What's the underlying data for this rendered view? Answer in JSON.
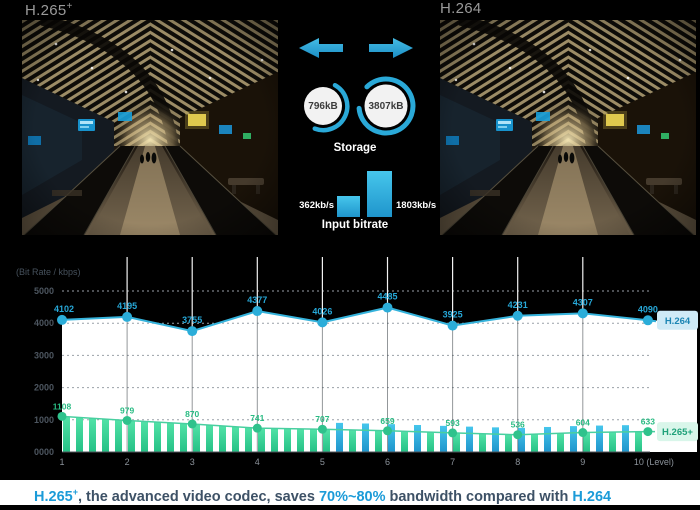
{
  "header": {
    "left_label_base": "H.265",
    "left_label_sup": "+",
    "right_label": "H.264"
  },
  "comparison": {
    "accent_color": "#29a9d9",
    "storage": {
      "title": "Storage",
      "left_value": "796kB",
      "right_value": "3807kB"
    },
    "bitrate": {
      "title": "Input bitrate",
      "left_value": "362kb/s",
      "right_value": "1803kb/s"
    }
  },
  "chart_data": {
    "type": "line",
    "title": "",
    "ylabel": "(Bit Rate / kbps)",
    "xlabel": "Level",
    "x": [
      1,
      2,
      3,
      4,
      5,
      6,
      7,
      8,
      9,
      10
    ],
    "x_tick_labels": [
      "1",
      "2",
      "3",
      "4",
      "5",
      "6",
      "7",
      "8",
      "9",
      "10 (Level)"
    ],
    "y_tick_labels": [
      "0000",
      "1000",
      "2000",
      "3000",
      "4000",
      "5000"
    ],
    "ylim": [
      0,
      5250
    ],
    "grid": "dotted-horizontal",
    "series": [
      {
        "name": "H.264",
        "type": "line",
        "color": "#35b3dc",
        "label_color": "#27a8d8",
        "values": [
          4102,
          4195,
          3755,
          4377,
          4026,
          4485,
          3925,
          4231,
          4307,
          4090
        ]
      },
      {
        "name": "H.265+",
        "type": "line-with-striped-bars",
        "color": "#49cfa0",
        "label_color": "#29bb83",
        "bar_color": "#2fcf96",
        "bar_alt_color": "#2fb2de",
        "values": [
          1108,
          979,
          870,
          741,
          707,
          659,
          593,
          536,
          604,
          633
        ]
      }
    ],
    "legend": [
      {
        "label": "H.264",
        "bg": "#cfeaf6",
        "color": "#1d86b4"
      },
      {
        "label": "H.265+",
        "bg": "#d9f6ea",
        "color": "#1fa179"
      }
    ],
    "legend_position": "right"
  },
  "caption": {
    "codec_left_base": "H.265",
    "codec_left_sup": "+",
    "text_1": ", the advanced video codec, saves ",
    "highlight": "70%~80%",
    "text_2": " bandwidth compared with ",
    "codec_right": "H.264",
    "highlight_color": "#1b9bd8",
    "text_color": "#3d5166"
  }
}
